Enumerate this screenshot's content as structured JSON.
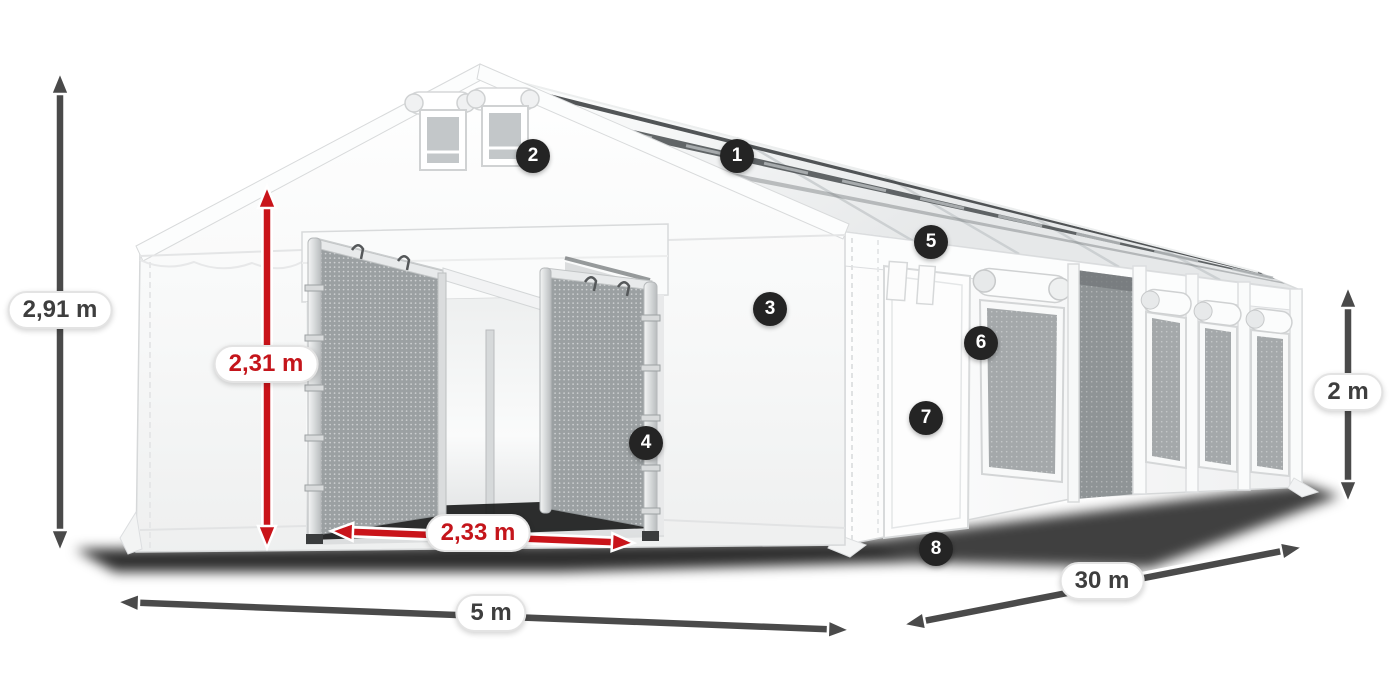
{
  "figure": {
    "type": "product-dimension-diagram",
    "subject": "white storage marquee tent with open entrance, mesh doors, side door and windows"
  },
  "colors": {
    "dimension_dark": "#4a4a4a",
    "dimension_red": "#c9141a",
    "badge_background": "#242424",
    "label_text_dark": "#3e3e3e",
    "label_text_red": "#c4151b"
  },
  "dimensions": [
    {
      "id": "total-height",
      "text": "2,91 m",
      "style": "dark"
    },
    {
      "id": "entrance-height",
      "text": "2,31 m",
      "style": "red"
    },
    {
      "id": "entrance-width",
      "text": "2,33 m",
      "style": "red"
    },
    {
      "id": "front-width",
      "text": "5 m",
      "style": "dark"
    },
    {
      "id": "side-length",
      "text": "30 m",
      "style": "dark"
    },
    {
      "id": "wall-height",
      "text": "2 m",
      "style": "dark"
    }
  ],
  "callouts": [
    {
      "number": "1"
    },
    {
      "number": "2"
    },
    {
      "number": "3"
    },
    {
      "number": "4"
    },
    {
      "number": "5"
    },
    {
      "number": "6"
    },
    {
      "number": "7"
    },
    {
      "number": "8"
    }
  ]
}
